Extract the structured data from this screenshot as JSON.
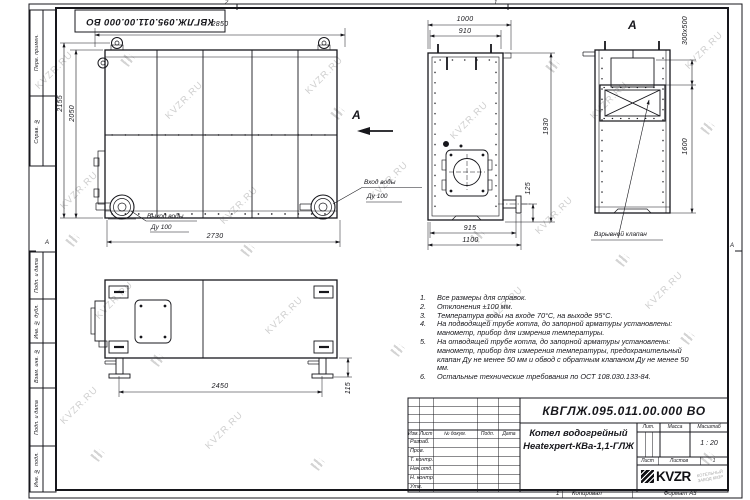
{
  "watermark": {
    "text": "KVZR.RU"
  },
  "frame": {
    "doc_number_stamp": "КВГЛЖ.095.011.00.000 ВО",
    "zone_top_left": "2",
    "zone_top_right": "1",
    "zone_left": "А",
    "zone_right": "А",
    "side_labels": [
      "Перв. примен.",
      "Справ. №",
      "Подп. и дата",
      "Инв. № дубл.",
      "Взам. инв. №",
      "Подп. и дата",
      "Инв. № подл."
    ]
  },
  "front_view": {
    "dim_width_top": "2850",
    "dim_height_outer": "2155",
    "dim_height_inner": "2050",
    "dim_width_bottom": "2730",
    "outlet_label1": "Выход воды",
    "outlet_label2": "Ду 100",
    "inlet_label1": "Вход воды",
    "inlet_label2": "Ду 100",
    "view_arrow_label": "А"
  },
  "end_view": {
    "dim_top_outer": "1000",
    "dim_top_inner": "910",
    "dim_height": "1930",
    "dim_flange": "125",
    "dim_bottom_inner": "915",
    "dim_bottom_outer": "1100"
  },
  "a_view": {
    "label": "А",
    "dim_opening": "300х500",
    "dim_height": "1600",
    "valve_label": "Взрывной клапан"
  },
  "side_view": {
    "dim_width": "2450",
    "dim_feet": "115"
  },
  "notes": [
    {
      "num": "1.",
      "text": "Все размеры для справок."
    },
    {
      "num": "2.",
      "text": "Отклонения ±100 мм."
    },
    {
      "num": "3.",
      "text": "Температура воды на входе 70°С, на выходе 95°С."
    },
    {
      "num": "4.",
      "text": "На подводящей трубе котла, до запорной арматуры установлены: манометр, прибор для измрения температуры."
    },
    {
      "num": "5.",
      "text": "На отводящей трубе котла, до запорной арматуры установлены: манометр, прибор для измерения температуры, предохранительный клапан Ду не менее 50 мм и обвод с обратным клапаном Ду не менее 50 мм."
    },
    {
      "num": "6.",
      "text": "Остальные технические требования по ОСТ 108.030.133-84."
    }
  ],
  "title_block": {
    "doc_number": "КВГЛЖ.095.011.00.000 ВО",
    "product_line1": "Котел водогрейный",
    "product_line2": "Heatexpert-КВа-1,1-ГЛЖ",
    "col_headers": {
      "izm": "Изм.",
      "list": "Лист",
      "doc": "№ докум.",
      "podp": "Подп.",
      "data": "Дата"
    },
    "rows": [
      "Разраб.",
      "Пров.",
      "Т. контр.",
      "Нач.отд.",
      "Н. контр.",
      "Утв."
    ],
    "lit_label": "Лит.",
    "mass_label": "Масса",
    "scale_label": "Масштаб",
    "scale_value": "1 : 20",
    "sheet_label": "Лист",
    "sheets_label": "Листов",
    "sheets_value": "1",
    "logo_text": "KVZR",
    "logo_sub1": "КОТЕЛЬНЫЙ",
    "logo_sub2": "ЗАВОД КВЗР",
    "copied_label": "Копировал",
    "format_label": "Формат А3",
    "page_num": "1"
  }
}
